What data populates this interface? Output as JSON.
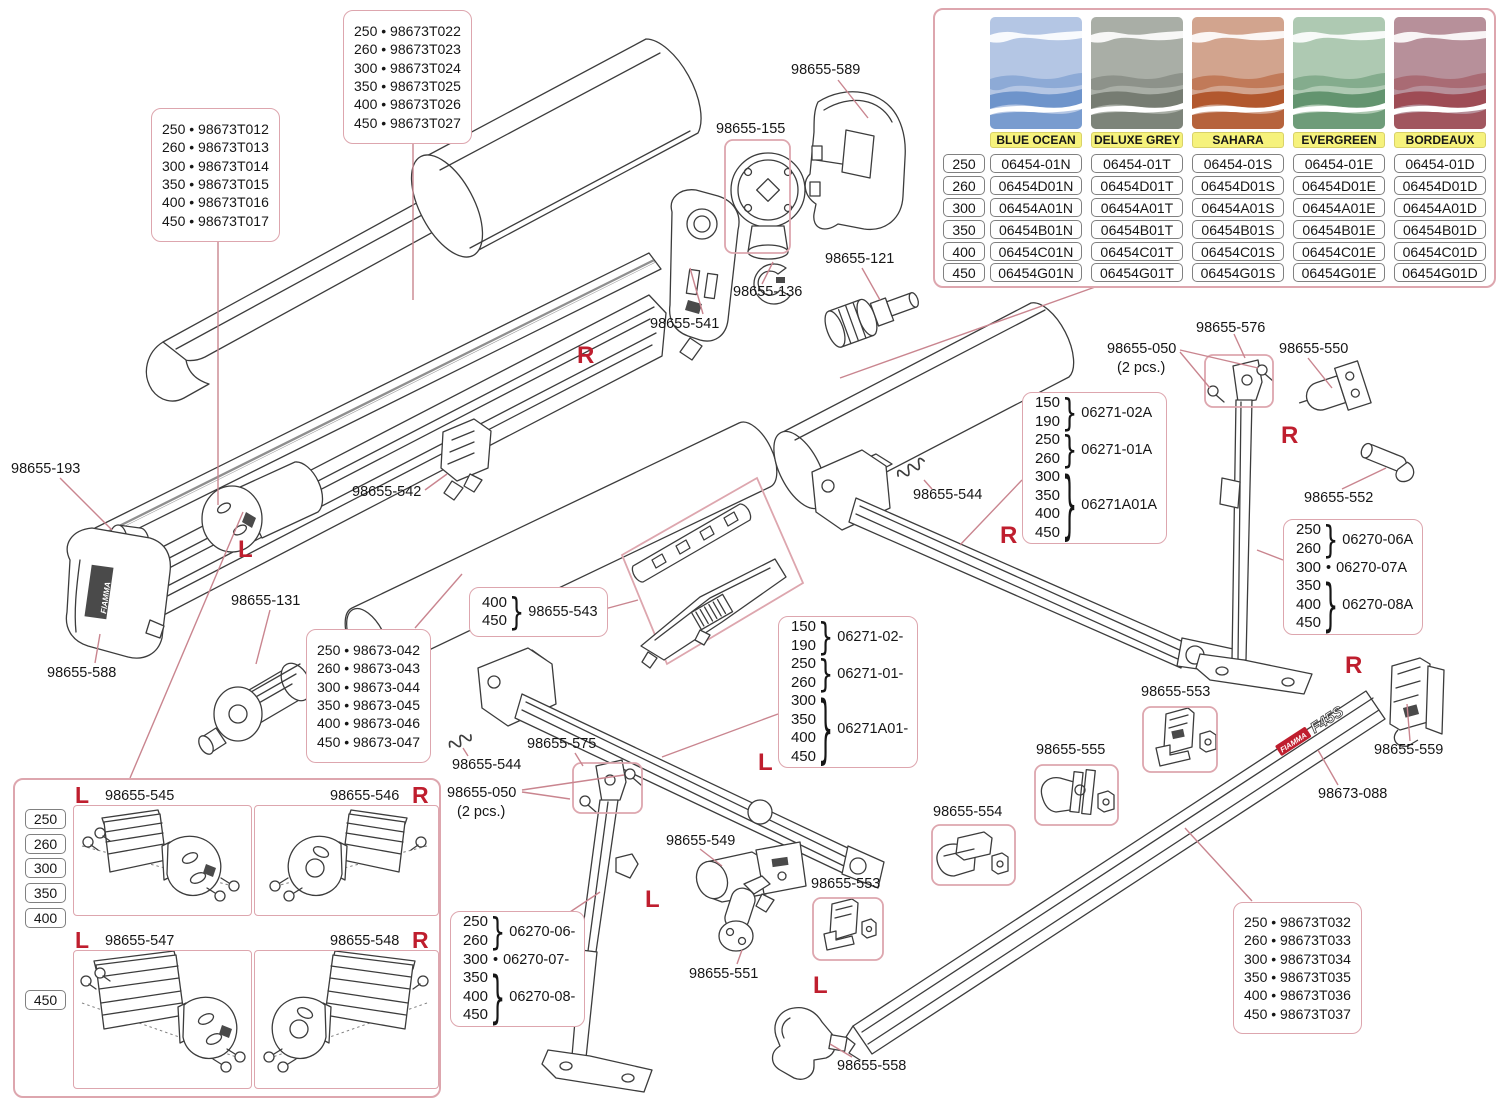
{
  "colors": {
    "line": "#3c3c3c",
    "leader": "#c9858f",
    "box_border": "#dda6ae",
    "red": "#bf1e2e",
    "text": "#161616",
    "badge_bg": "#f6f27c",
    "cell_border": "#808080"
  },
  "ui": {
    "bullet": "•",
    "brace": "}"
  },
  "markers": {
    "left": "L",
    "right": "R"
  },
  "logo": {
    "brand": "FIAMMA",
    "model": "F45S"
  },
  "labels": {
    "p193": "98655-193",
    "p588": "98655-588",
    "p131": "98655-131",
    "p541": "98655-541",
    "p542": "98655-542",
    "p155": "98655-155",
    "p136": "98655-136",
    "p589": "98655-589",
    "p121": "98655-121",
    "p544": "98655-544",
    "p575": "98655-575",
    "p576": "98655-576",
    "p050": "98655-050",
    "p050_qty": "(2 pcs.)",
    "p550": "98655-550",
    "p552": "98655-552",
    "p549": "98655-549",
    "p551": "98655-551",
    "p553": "98655-553",
    "p554": "98655-554",
    "p555": "98655-555",
    "p558": "98655-558",
    "p559": "98655-559",
    "p088": "98673-088",
    "p545": "98655-545",
    "p546": "98655-546",
    "p547": "98655-547",
    "p548": "98655-548"
  },
  "part_boxes": {
    "fabric_top": [
      "250 • 98673T022",
      "260 • 98673T023",
      "300 • 98673T024",
      "350 • 98673T025",
      "400 • 98673T026",
      "450 • 98673T027"
    ],
    "case_profile": [
      "250 • 98673T012",
      "260 • 98673T013",
      "300 • 98673T014",
      "350 • 98673T015",
      "400 • 98673T016",
      "450 • 98673T017"
    ],
    "roller_tube": [
      "250 • 98673-042",
      "260 • 98673-043",
      "300 • 98673-044",
      "350 • 98673-045",
      "400 • 98673-046",
      "450 • 98673-047"
    ],
    "lead_bar": [
      "250 • 98673T032",
      "260 • 98673T033",
      "300 • 98673T034",
      "350 • 98673T035",
      "400 • 98673T036",
      "450 • 98673T037"
    ]
  },
  "grouped_boxes": {
    "holddown": {
      "sizes": [
        "400",
        "450"
      ],
      "part": "98655-543"
    },
    "arm_right": {
      "g1_sizes": [
        "150",
        "190"
      ],
      "g1_part": "06271-02A",
      "g2_sizes": [
        "250",
        "260"
      ],
      "g2_part": "06271-01A",
      "g3_sizes": [
        "300",
        "350",
        "400",
        "450"
      ],
      "g3_part": "06271A01A"
    },
    "arm_left": {
      "g1_sizes": [
        "150",
        "190"
      ],
      "g1_part": "06271-02-",
      "g2_sizes": [
        "250",
        "260"
      ],
      "g2_part": "06271-01-",
      "g3_sizes": [
        "300",
        "350",
        "400",
        "450"
      ],
      "g3_part": "06271A01-"
    },
    "leg_left": {
      "g1_sizes": [
        "250",
        "260"
      ],
      "g1_part": "06270-06-",
      "g2_size": "300",
      "g2_part": "06270-07-",
      "g3_sizes": [
        "350",
        "400",
        "450"
      ],
      "g3_part": "06270-08-"
    },
    "leg_right": {
      "g1_sizes": [
        "250",
        "260"
      ],
      "g1_part": "06270-06A",
      "g2_size": "300",
      "g2_part": "06270-07A",
      "g3_sizes": [
        "350",
        "400",
        "450"
      ],
      "g3_part": "06270-08A"
    }
  },
  "color_table": {
    "sizes": [
      "250",
      "260",
      "300",
      "350",
      "400",
      "450"
    ],
    "columns": [
      {
        "name": "BLUE OCEAN",
        "base": "#b4c6e4",
        "dark": "#6e94cb",
        "codes": [
          "06454-01N",
          "06454D01N",
          "06454A01N",
          "06454B01N",
          "06454C01N",
          "06454G01N"
        ]
      },
      {
        "name": "DELUXE GREY",
        "base": "#a9aea6",
        "dark": "#767c72",
        "codes": [
          "06454-01T",
          "06454D01T",
          "06454A01T",
          "06454B01T",
          "06454C01T",
          "06454G01T"
        ]
      },
      {
        "name": "SAHARA",
        "base": "#d2a48e",
        "dark": "#b2582e",
        "codes": [
          "06454-01S",
          "06454D01S",
          "06454A01S",
          "06454B01S",
          "06454C01S",
          "06454G01S"
        ]
      },
      {
        "name": "EVERGREEN",
        "base": "#aec9b2",
        "dark": "#63946f",
        "codes": [
          "06454-01E",
          "06454D01E",
          "06454A01E",
          "06454B01E",
          "06454C01E",
          "06454G01E"
        ]
      },
      {
        "name": "BORDEAUX",
        "base": "#b7909a",
        "dark": "#9e4c55",
        "codes": [
          "06454-01D",
          "06454D01D",
          "06454A01D",
          "06454B01D",
          "06454C01D",
          "06454G01D"
        ]
      }
    ]
  },
  "corner_panel": {
    "top_sizes": [
      "250",
      "260",
      "300",
      "350",
      "400"
    ],
    "bottom_sizes": [
      "450"
    ]
  }
}
